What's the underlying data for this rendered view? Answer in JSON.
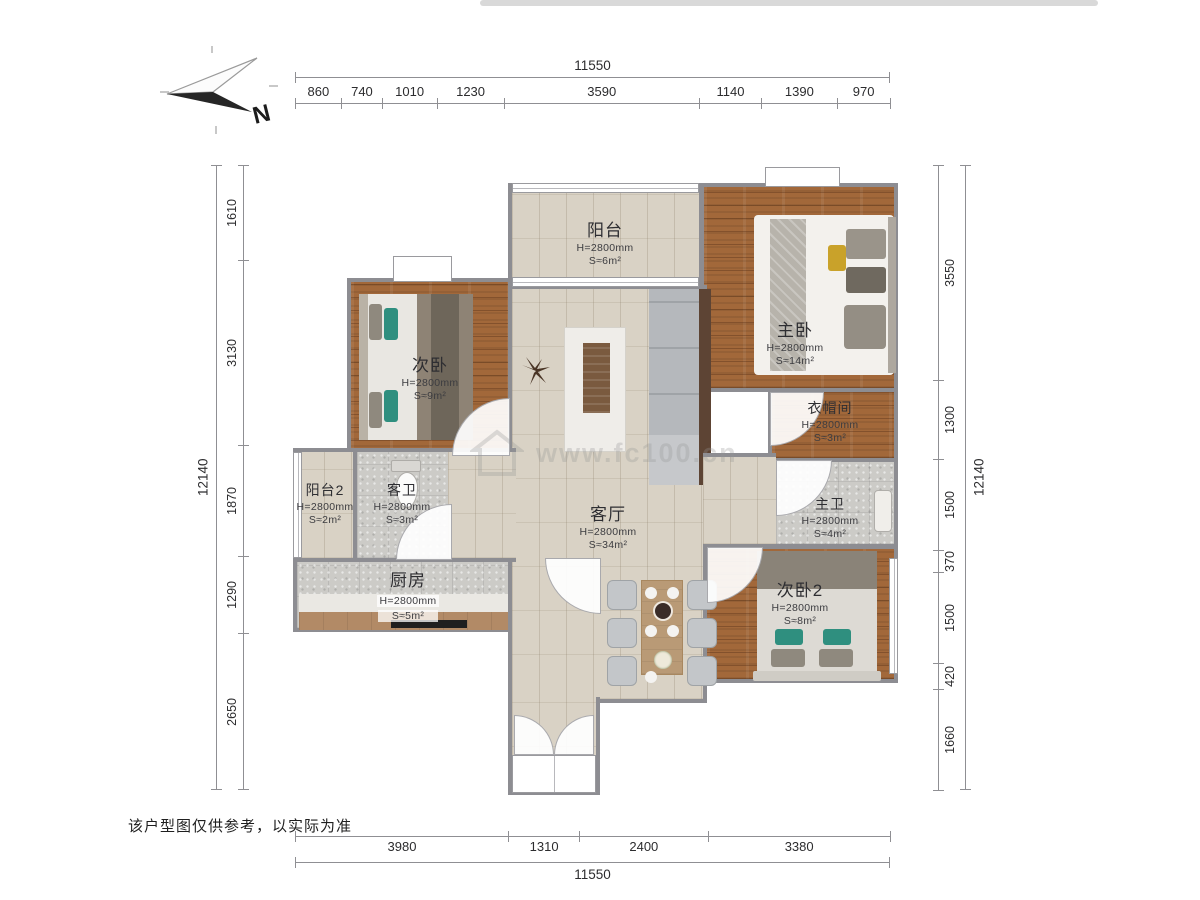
{
  "compass": {
    "label": "N"
  },
  "watermark": {
    "site": "www.fc100.cn"
  },
  "disclaimer": "该户型图仅供参考，以实际为准",
  "dimensions": {
    "top": {
      "total": "11550",
      "segments": [
        "860",
        "740",
        "1010",
        "1230",
        "3590",
        "1140",
        "1390",
        "970"
      ]
    },
    "bottom": {
      "total": "11550",
      "segments": [
        "3980",
        "1310",
        "2400",
        "3380"
      ]
    },
    "left": {
      "total": "12140",
      "segments": [
        "1610",
        "3130",
        "1870",
        "1290",
        "2650"
      ]
    },
    "right": {
      "total": "12140",
      "segments": [
        "3550",
        "1300",
        "1500",
        "370",
        "1500",
        "420",
        "1660"
      ]
    }
  },
  "rooms": {
    "balcony": {
      "name": "阳台",
      "ceiling": "H=2800mm",
      "area": "S≈6m²"
    },
    "master": {
      "name": "主卧",
      "ceiling": "H=2800mm",
      "area": "S≈14m²"
    },
    "bedroom": {
      "name": "次卧",
      "ceiling": "H=2800mm",
      "area": "S≈9m²"
    },
    "cloakroom": {
      "name": "衣帽间",
      "ceiling": "H=2800mm",
      "area": "S≈3m²"
    },
    "master_bath": {
      "name": "主卫",
      "ceiling": "H=2800mm",
      "area": "S≈4m²"
    },
    "bedroom2": {
      "name": "次卧2",
      "ceiling": "H=2800mm",
      "area": "S≈8m²"
    },
    "balcony2": {
      "name": "阳台2",
      "ceiling": "H=2800mm",
      "area": "S≈2m²"
    },
    "guest_bath": {
      "name": "客卫",
      "ceiling": "H=2800mm",
      "area": "S≈3m²"
    },
    "kitchen": {
      "name": "厨房",
      "ceiling": "H=2800mm",
      "area": "S≈5m²"
    },
    "living": {
      "name": "客厅",
      "ceiling": "H=2800mm",
      "area": "S≈34m²"
    }
  }
}
